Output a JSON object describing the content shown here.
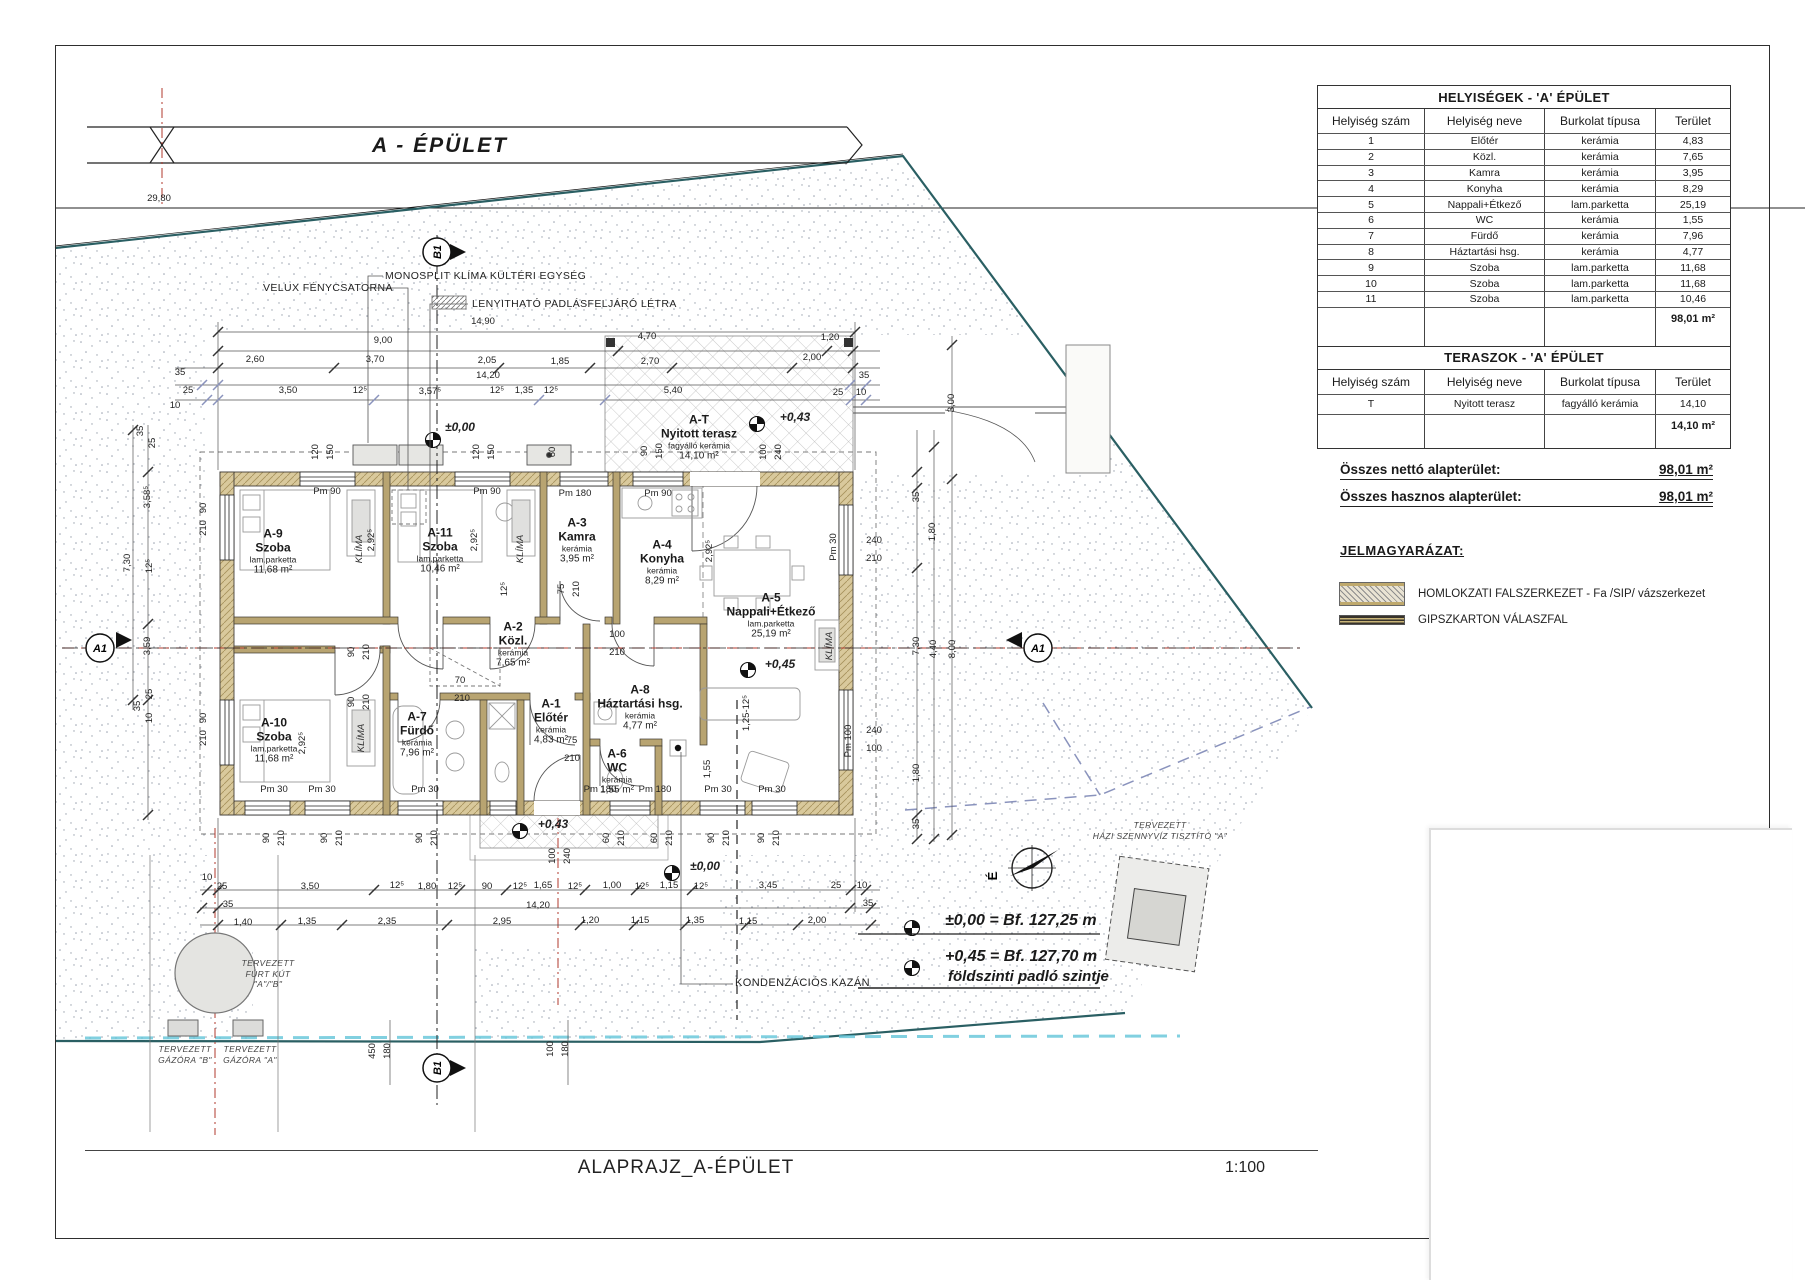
{
  "banner": {
    "title": "A - ÉPÜLET"
  },
  "markers": {
    "a1": "A1",
    "b1": "B1",
    "north": "É"
  },
  "tables": {
    "rooms": {
      "title": "HELYISÉGEK - 'A' ÉPÜLET",
      "headers": [
        "Helyiség szám",
        "Helyiség neve",
        "Burkolat típusa",
        "Terület"
      ],
      "rows": [
        {
          "num": "1",
          "name": "Előtér",
          "floor": "kerámia",
          "area": "4,83"
        },
        {
          "num": "2",
          "name": "Közl.",
          "floor": "kerámia",
          "area": "7,65"
        },
        {
          "num": "3",
          "name": "Kamra",
          "floor": "kerámia",
          "area": "3,95"
        },
        {
          "num": "4",
          "name": "Konyha",
          "floor": "kerámia",
          "area": "8,29"
        },
        {
          "num": "5",
          "name": "Nappali+Étkező",
          "floor": "lam.parketta",
          "area": "25,19"
        },
        {
          "num": "6",
          "name": "WC",
          "floor": "kerámia",
          "area": "1,55"
        },
        {
          "num": "7",
          "name": "Fürdő",
          "floor": "kerámia",
          "area": "7,96"
        },
        {
          "num": "8",
          "name": "Háztartási hsg.",
          "floor": "kerámia",
          "area": "4,77"
        },
        {
          "num": "9",
          "name": "Szoba",
          "floor": "lam.parketta",
          "area": "11,68"
        },
        {
          "num": "10",
          "name": "Szoba",
          "floor": "lam.parketta",
          "area": "11,68"
        },
        {
          "num": "11",
          "name": "Szoba",
          "floor": "lam.parketta",
          "area": "10,46"
        }
      ],
      "total": "98,01 m²"
    },
    "terraces": {
      "title": "TERASZOK - 'A' ÉPÜLET",
      "headers": [
        "Helyiség szám",
        "Helyiség neve",
        "Burkolat típusa",
        "Terület"
      ],
      "rows": [
        {
          "num": "T",
          "name": "Nyitott terasz",
          "floor": "fagyálló kerámia",
          "area": "14,10"
        }
      ],
      "total": "14,10 m²"
    }
  },
  "totals": {
    "netto_label": "Összes nettó alapterület:",
    "netto_value": "98,01 m²",
    "hasznos_label": "Összes hasznos alapterület:",
    "hasznos_value": "98,01 m²"
  },
  "legend": {
    "title": "JELMAGYARÁZAT:",
    "items": [
      {
        "label": "HOMLOKZATI FALSZERKEZET - Fa /SIP/ vázszerkezet"
      },
      {
        "label": "GIPSZKARTON VÁLASZFAL"
      }
    ]
  },
  "rooms": [
    {
      "id": "A-9",
      "name": "Szoba",
      "floor": "lam.parketta",
      "area": "11,68 m²",
      "x": 273,
      "y": 552
    },
    {
      "id": "A-11",
      "name": "Szoba",
      "floor": "lam.parketta",
      "area": "10,46 m²",
      "x": 440,
      "y": 551
    },
    {
      "id": "A-3",
      "name": "Kamra",
      "floor": "kerámia",
      "area": "3,95 m²",
      "x": 577,
      "y": 541
    },
    {
      "id": "A-4",
      "name": "Konyha",
      "floor": "kerámia",
      "area": "8,29 m²",
      "x": 662,
      "y": 563
    },
    {
      "id": "A-5",
      "name": "Nappali+Étkező",
      "floor": "lam.parketta",
      "area": "25,19 m²",
      "x": 771,
      "y": 616
    },
    {
      "id": "A-2",
      "name": "Közl.",
      "floor": "kerámia",
      "area": "7,65 m²",
      "x": 513,
      "y": 645
    },
    {
      "id": "A-1",
      "name": "Előtér",
      "floor": "kerámia",
      "area": "4,83 m²",
      "x": 551,
      "y": 722
    },
    {
      "id": "A-8",
      "name": "Háztartási hsg.",
      "floor": "kerámia",
      "area": "4,77 m²",
      "x": 640,
      "y": 708
    },
    {
      "id": "A-6",
      "name": "WC",
      "floor": "kerámia",
      "area": "1,55 m²",
      "x": 617,
      "y": 772
    },
    {
      "id": "A-7",
      "name": "Fürdő",
      "floor": "kerámia",
      "area": "7,96 m²",
      "x": 417,
      "y": 735
    },
    {
      "id": "A-10",
      "name": "Szoba",
      "floor": "lam.parketta",
      "area": "11,68 m²",
      "x": 274,
      "y": 741
    },
    {
      "id": "A-T",
      "name": "Nyitott terasz",
      "floor": "fagyálló kerámia",
      "area": "14,10 m²",
      "x": 699,
      "y": 438
    }
  ],
  "annotations": {
    "velux": "VELUX FÉNYCSATORNA",
    "monosplit": "MONOSPLIT KLÍMA KÜLTÉRI EGYSÉG",
    "letra": "LENYITHATÓ PADLÁSFELJÁRÓ LÉTRA",
    "kazan": "KONDENZÁCIÓS KAZÁN",
    "kut": [
      "TERVEZETT",
      "FÚRT KÚT",
      "\"A\"/\"B\""
    ],
    "gazora_b": [
      "TERVEZETT",
      "GÁZÓRA \"B\""
    ],
    "gazora_a": [
      "TERVEZETT",
      "GÁZÓRA \"A\""
    ],
    "szennyviz": [
      "TERVEZETT",
      "HÁZI SZENNYVÍZ TISZTÍTÓ \"A\""
    ],
    "bench1": "±0,00 = Bf. 127,25 m",
    "bench2": "+0,45 = Bf. 127,70 m",
    "bench2b": "földszinti padló szintje"
  },
  "footer": {
    "title": "ALAPRAJZ_A-ÉPÜLET",
    "scale": "1:100"
  },
  "colors": {
    "wall_tan": "#d9c99c",
    "boundary_teal": "#2a5f63",
    "centerline_red": "#b03a2e",
    "setback_blue": "#8a93bd",
    "water_cyan": "#62c4d8"
  },
  "dims": [
    {
      "t": "29,80",
      "x": 159,
      "y": 199
    },
    {
      "t": "14,90",
      "x": 483,
      "y": 322
    },
    {
      "t": "9,00",
      "x": 383,
      "y": 341
    },
    {
      "t": "4,70",
      "x": 647,
      "y": 337
    },
    {
      "t": "1,20",
      "x": 830,
      "y": 338
    },
    {
      "t": "2,60",
      "x": 255,
      "y": 360
    },
    {
      "t": "3,70",
      "x": 375,
      "y": 360
    },
    {
      "t": "2,05",
      "x": 487,
      "y": 361
    },
    {
      "t": "1,85",
      "x": 560,
      "y": 362
    },
    {
      "t": "2,70",
      "x": 650,
      "y": 362
    },
    {
      "t": "2,00",
      "x": 812,
      "y": 358
    },
    {
      "t": "35",
      "x": 180,
      "y": 373
    },
    {
      "t": "14,20",
      "x": 488,
      "y": 376
    },
    {
      "t": "35",
      "x": 864,
      "y": 376
    },
    {
      "t": "25",
      "x": 188,
      "y": 391
    },
    {
      "t": "3,50",
      "x": 288,
      "y": 391
    },
    {
      "t": "12⁵",
      "x": 360,
      "y": 391
    },
    {
      "t": "3,57⁵",
      "x": 430,
      "y": 392
    },
    {
      "t": "12⁵",
      "x": 497,
      "y": 391
    },
    {
      "t": "1,35",
      "x": 524,
      "y": 391
    },
    {
      "t": "12⁵",
      "x": 551,
      "y": 391
    },
    {
      "t": "5,40",
      "x": 673,
      "y": 391
    },
    {
      "t": "25",
      "x": 838,
      "y": 393
    },
    {
      "t": "10",
      "x": 861,
      "y": 393
    },
    {
      "t": "10",
      "x": 175,
      "y": 406
    },
    {
      "t": "3,00",
      "x": 952,
      "y": 403,
      "r": -90
    },
    {
      "t": "35",
      "x": 141,
      "y": 431,
      "r": -90
    },
    {
      "t": "25",
      "x": 153,
      "y": 443,
      "r": -90
    },
    {
      "t": "3,58⁵",
      "x": 148,
      "y": 497,
      "r": -90
    },
    {
      "t": "7,30",
      "x": 128,
      "y": 563,
      "r": -90
    },
    {
      "t": "12⁵",
      "x": 150,
      "y": 566,
      "r": -90
    },
    {
      "t": "3,59",
      "x": 148,
      "y": 646,
      "r": -90
    },
    {
      "t": "25",
      "x": 150,
      "y": 694,
      "r": -90
    },
    {
      "t": "35",
      "x": 138,
      "y": 706,
      "r": -90
    },
    {
      "t": "10",
      "x": 150,
      "y": 718,
      "r": -90
    },
    {
      "t": "90",
      "x": 204,
      "y": 508,
      "r": -90
    },
    {
      "t": "210",
      "x": 204,
      "y": 528,
      "r": -90
    },
    {
      "t": "90",
      "x": 204,
      "y": 718,
      "r": -90
    },
    {
      "t": "210",
      "x": 204,
      "y": 738,
      "r": -90
    },
    {
      "t": "Pm 90",
      "x": 327,
      "y": 492
    },
    {
      "t": "Pm 90",
      "x": 487,
      "y": 492
    },
    {
      "t": "Pm 180",
      "x": 575,
      "y": 494
    },
    {
      "t": "Pm 90",
      "x": 658,
      "y": 494
    },
    {
      "t": "120",
      "x": 316,
      "y": 452,
      "r": -90
    },
    {
      "t": "150",
      "x": 331,
      "y": 452,
      "r": -90
    },
    {
      "t": "120",
      "x": 477,
      "y": 452,
      "r": -90
    },
    {
      "t": "150",
      "x": 492,
      "y": 452,
      "r": -90
    },
    {
      "t": "60",
      "x": 553,
      "y": 452,
      "r": -90
    },
    {
      "t": "90",
      "x": 645,
      "y": 451,
      "r": -90
    },
    {
      "t": "150",
      "x": 660,
      "y": 451,
      "r": -90
    },
    {
      "t": "100",
      "x": 764,
      "y": 452,
      "r": -90
    },
    {
      "t": "240",
      "x": 779,
      "y": 452,
      "r": -90
    },
    {
      "t": "35",
      "x": 917,
      "y": 497,
      "r": -90
    },
    {
      "t": "1,80",
      "x": 933,
      "y": 532,
      "r": -90
    },
    {
      "t": "240",
      "x": 874,
      "y": 541
    },
    {
      "t": "210",
      "x": 874,
      "y": 559
    },
    {
      "t": "Pm 30",
      "x": 834,
      "y": 547,
      "r": -90
    },
    {
      "t": "7,30",
      "x": 917,
      "y": 646,
      "r": -90
    },
    {
      "t": "4,40",
      "x": 934,
      "y": 649,
      "r": -90
    },
    {
      "t": "8,00",
      "x": 953,
      "y": 649,
      "r": -90
    },
    {
      "t": "1,80",
      "x": 917,
      "y": 773,
      "r": -90
    },
    {
      "t": "35",
      "x": 917,
      "y": 824,
      "r": -90
    },
    {
      "t": "240",
      "x": 874,
      "y": 731
    },
    {
      "t": "100",
      "x": 874,
      "y": 749
    },
    {
      "t": "Pm 100",
      "x": 849,
      "y": 741,
      "r": -90
    },
    {
      "t": "±0,00",
      "x": 460,
      "y": 427,
      "c": "lvl"
    },
    {
      "t": "+0,43",
      "x": 795,
      "y": 417,
      "c": "lvl"
    },
    {
      "t": "+0,45",
      "x": 780,
      "y": 664,
      "c": "lvl"
    },
    {
      "t": "+0,43",
      "x": 553,
      "y": 824,
      "c": "lvl"
    },
    {
      "t": "±0,00",
      "x": 705,
      "y": 866,
      "c": "lvl"
    },
    {
      "t": "Pm 30",
      "x": 274,
      "y": 790
    },
    {
      "t": "Pm 30",
      "x": 322,
      "y": 790
    },
    {
      "t": "Pm 30",
      "x": 425,
      "y": 790
    },
    {
      "t": "Pm 180",
      "x": 600,
      "y": 790
    },
    {
      "t": "Pm 180",
      "x": 655,
      "y": 790
    },
    {
      "t": "Pm 30",
      "x": 718,
      "y": 790
    },
    {
      "t": "Pm 30",
      "x": 772,
      "y": 790
    },
    {
      "t": "90",
      "x": 267,
      "y": 838,
      "r": -90
    },
    {
      "t": "210",
      "x": 282,
      "y": 838,
      "r": -90
    },
    {
      "t": "90",
      "x": 325,
      "y": 838,
      "r": -90
    },
    {
      "t": "210",
      "x": 340,
      "y": 838,
      "r": -90
    },
    {
      "t": "90",
      "x": 420,
      "y": 838,
      "r": -90
    },
    {
      "t": "210",
      "x": 435,
      "y": 838,
      "r": -90
    },
    {
      "t": "60",
      "x": 607,
      "y": 838,
      "r": -90
    },
    {
      "t": "210",
      "x": 622,
      "y": 838,
      "r": -90
    },
    {
      "t": "60",
      "x": 655,
      "y": 838,
      "r": -90
    },
    {
      "t": "210",
      "x": 670,
      "y": 838,
      "r": -90
    },
    {
      "t": "90",
      "x": 712,
      "y": 838,
      "r": -90
    },
    {
      "t": "210",
      "x": 727,
      "y": 838,
      "r": -90
    },
    {
      "t": "90",
      "x": 762,
      "y": 838,
      "r": -90
    },
    {
      "t": "210",
      "x": 777,
      "y": 838,
      "r": -90
    },
    {
      "t": "100",
      "x": 553,
      "y": 856,
      "r": -90
    },
    {
      "t": "240",
      "x": 568,
      "y": 856,
      "r": -90
    },
    {
      "t": "2,92⁵",
      "x": 372,
      "y": 540,
      "r": -90
    },
    {
      "t": "2,92⁵",
      "x": 475,
      "y": 540,
      "r": -90
    },
    {
      "t": "2,92⁵",
      "x": 710,
      "y": 551,
      "r": -90
    },
    {
      "t": "2,92⁵",
      "x": 303,
      "y": 743,
      "r": -90
    },
    {
      "t": "75",
      "x": 562,
      "y": 589,
      "r": -90
    },
    {
      "t": "210",
      "x": 577,
      "y": 589,
      "r": -90
    },
    {
      "t": "12⁵",
      "x": 505,
      "y": 589,
      "r": -90
    },
    {
      "t": "90",
      "x": 352,
      "y": 652,
      "r": -90
    },
    {
      "t": "210",
      "x": 367,
      "y": 652,
      "r": -90
    },
    {
      "t": "90",
      "x": 352,
      "y": 702,
      "r": -90
    },
    {
      "t": "210",
      "x": 367,
      "y": 702,
      "r": -90
    },
    {
      "t": "100",
      "x": 617,
      "y": 635
    },
    {
      "t": "210",
      "x": 617,
      "y": 653
    },
    {
      "t": "70",
      "x": 460,
      "y": 681
    },
    {
      "t": "210",
      "x": 462,
      "y": 699
    },
    {
      "t": "75",
      "x": 572,
      "y": 741
    },
    {
      "t": "210",
      "x": 572,
      "y": 759
    },
    {
      "t": "1,55",
      "x": 708,
      "y": 769,
      "r": -90
    },
    {
      "t": "1,25-12⁵",
      "x": 747,
      "y": 713,
      "r": -90
    },
    {
      "t": "KLÍMA",
      "x": 360,
      "y": 549,
      "r": -90,
      "c": "itl"
    },
    {
      "t": "KLÍMA",
      "x": 521,
      "y": 549,
      "r": -90,
      "c": "itl"
    },
    {
      "t": "KLÍMA",
      "x": 362,
      "y": 738,
      "r": -90,
      "c": "itl"
    },
    {
      "t": "KLÍMA",
      "x": 830,
      "y": 646,
      "r": -90,
      "c": "itl"
    },
    {
      "t": "10",
      "x": 207,
      "y": 878
    },
    {
      "t": "25",
      "x": 222,
      "y": 887
    },
    {
      "t": "3,50",
      "x": 310,
      "y": 887
    },
    {
      "t": "12⁵",
      "x": 397,
      "y": 886
    },
    {
      "t": "1,80",
      "x": 427,
      "y": 887
    },
    {
      "t": "12⁵",
      "x": 455,
      "y": 887
    },
    {
      "t": "90",
      "x": 487,
      "y": 887
    },
    {
      "t": "12⁵",
      "x": 520,
      "y": 887
    },
    {
      "t": "1,65",
      "x": 543,
      "y": 886
    },
    {
      "t": "12⁵",
      "x": 575,
      "y": 887
    },
    {
      "t": "1,00",
      "x": 612,
      "y": 886
    },
    {
      "t": "12⁵",
      "x": 642,
      "y": 887
    },
    {
      "t": "1,15",
      "x": 669,
      "y": 886
    },
    {
      "t": "12⁵",
      "x": 701,
      "y": 887
    },
    {
      "t": "3,45",
      "x": 768,
      "y": 886
    },
    {
      "t": "25",
      "x": 836,
      "y": 886
    },
    {
      "t": "10",
      "x": 862,
      "y": 886
    },
    {
      "t": "35",
      "x": 228,
      "y": 905
    },
    {
      "t": "14,20",
      "x": 538,
      "y": 906
    },
    {
      "t": "35",
      "x": 868,
      "y": 904
    },
    {
      "t": "1,40",
      "x": 243,
      "y": 923
    },
    {
      "t": "1,35",
      "x": 307,
      "y": 922
    },
    {
      "t": "2,35",
      "x": 387,
      "y": 922
    },
    {
      "t": "2,95",
      "x": 502,
      "y": 922
    },
    {
      "t": "1,20",
      "x": 590,
      "y": 921
    },
    {
      "t": "1,15",
      "x": 640,
      "y": 921
    },
    {
      "t": "1,35",
      "x": 695,
      "y": 921
    },
    {
      "t": "1,15",
      "x": 748,
      "y": 922
    },
    {
      "t": "2,00",
      "x": 817,
      "y": 921
    },
    {
      "t": "450",
      "x": 373,
      "y": 1051,
      "r": -90
    },
    {
      "t": "180",
      "x": 388,
      "y": 1051,
      "r": -90
    },
    {
      "t": "100",
      "x": 551,
      "y": 1049,
      "r": -90
    },
    {
      "t": "180",
      "x": 566,
      "y": 1049,
      "r": -90
    }
  ]
}
